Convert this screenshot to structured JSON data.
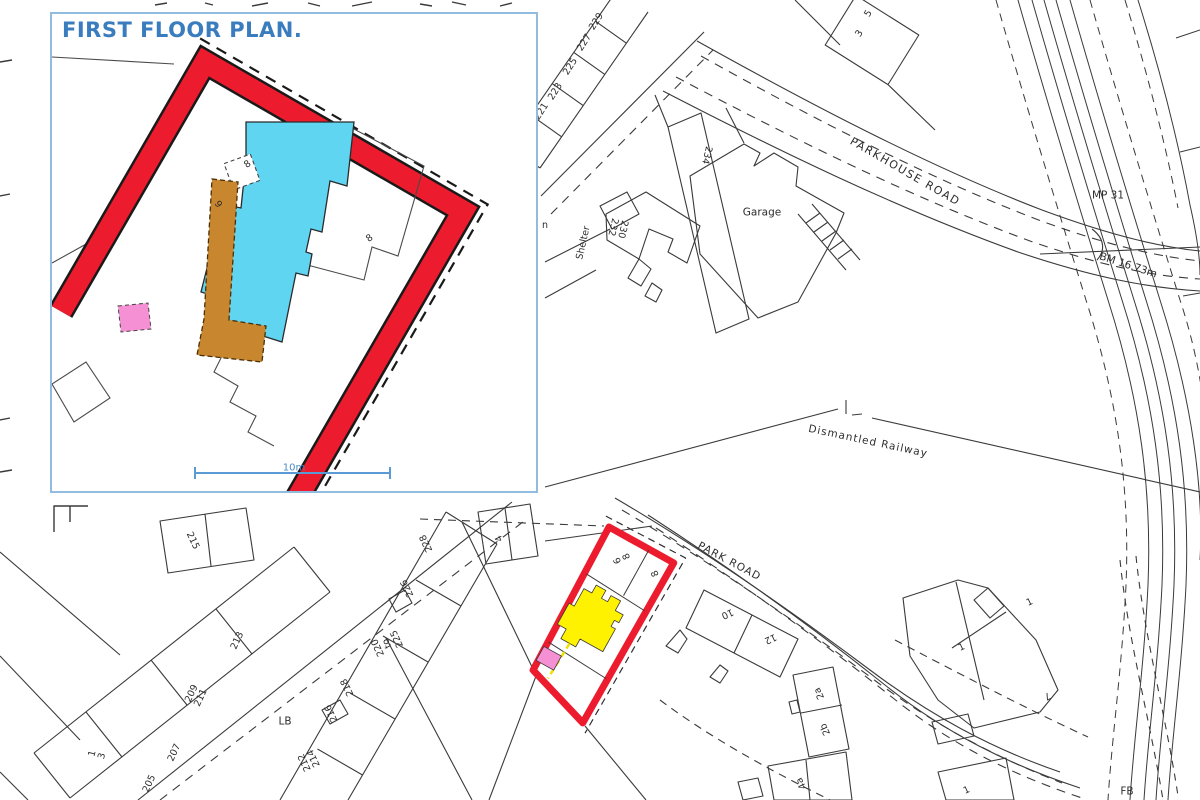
{
  "inset": {
    "title": "FIRST FLOOR PLAN.",
    "scale_label": "10m",
    "numbers": {
      "a": "8",
      "b": "6",
      "c": "8"
    },
    "colors": {
      "border_blue": "#92bcdf",
      "title_blue": "#3a7dbf",
      "wall_red": "#ec1c2e",
      "first_floor_cyan": "#5fd5f2",
      "corridor_brown": "#c8872f",
      "highlight_pink": "#f590d5",
      "scale_blue": "#5b9bd5"
    }
  },
  "map": {
    "road_labels": {
      "parkhouse": "PARKHOUSE ROAD",
      "park": "PARK ROAD"
    },
    "feature_labels": {
      "dismantled_railway": "Dismantled Railway",
      "garage": "Garage",
      "shelter": "Shelter",
      "mp": "MP 31",
      "bm": "BM 16.73m",
      "lb": "LB",
      "fb": "FB",
      "n": "n"
    },
    "house_numbers": {
      "n229": "229",
      "n227": "227",
      "n225": "225",
      "n223": "223",
      "n221": "221",
      "n5": "5",
      "n3": "3",
      "n234": "234",
      "n230_232": "230\n232",
      "n215": "215",
      "n213": "213",
      "n209_211": "209\n211",
      "n207": "207",
      "n205": "205",
      "n1_3": "1\n3",
      "n228": "228",
      "n226": "226",
      "n220_225": "220\nto\n225",
      "n218": "218",
      "n216": "216",
      "n212_214": "212\n214",
      "n4": "4",
      "n10": "10",
      "n12": "12",
      "n2a": "2a",
      "n2b": "2b",
      "n4a": "4a",
      "n1a": "1",
      "n1b": "1",
      "n7": "7",
      "n1c": "1"
    },
    "plot": {
      "numbers": {
        "left": "6\n8",
        "right": "8"
      },
      "outline_red": "#ec1c2e",
      "building_yellow": "#fff200",
      "highlight_pink": "#f590d5"
    }
  }
}
